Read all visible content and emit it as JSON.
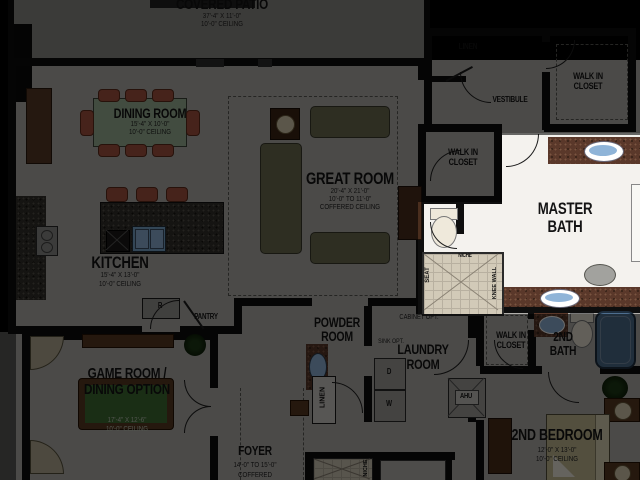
{
  "plan": {
    "covered_patio": {
      "name": "COVERED PATIO",
      "dims": "37'-4\" X 11'-0\"",
      "ceiling": "10'-0\" CEILING"
    },
    "dining_room": {
      "name": "DINING ROOM",
      "dims": "15'-4\" X 10'-0\"",
      "ceiling": "10'-0\" CEILING"
    },
    "great_room": {
      "name": "GREAT ROOM",
      "dims": "20'-4\" X 21'-0\"",
      "ceiling_range": "10'-0\" TO 11'-0\"",
      "ceiling_type": "COFFERED CEILING"
    },
    "kitchen": {
      "name": "KITCHEN",
      "dims": "15'-4\" X 13'-0\"",
      "ceiling": "10'-0\" CEILING"
    },
    "pantry": {
      "name": "PANTRY"
    },
    "refrigerator": {
      "abbr": "R"
    },
    "linen_upper": {
      "name": "LINEN"
    },
    "vestibule": {
      "name": "VESTIBULE"
    },
    "walk_in_closet_top": {
      "name": "WALK IN CLOSET"
    },
    "walk_in_closet_mid": {
      "name": "WALK IN CLOSET"
    },
    "walk_in_closet_bottom": {
      "name": "WALK IN CLOSET"
    },
    "master_bath": {
      "name": "MASTER BATH",
      "niche": "NICHE",
      "seat": "SEAT",
      "knee_wall": "KNEE WALL"
    },
    "powder_room": {
      "name": "POWDER ROOM"
    },
    "laundry_room": {
      "name": "LAUNDRY ROOM",
      "cabinet_opt": "CABINET OPT.",
      "sink_opt": "SINK OPT.",
      "dryer": "D",
      "washer": "W"
    },
    "linen_hall": {
      "name": "LINEN"
    },
    "ahu": {
      "name": "AHU"
    },
    "second_bath": {
      "name": "2ND BATH"
    },
    "second_bedroom": {
      "name": "2ND BEDROOM",
      "dims": "12'-0\" X 13'-0\"",
      "ceiling": "10'-0\" CEILING"
    },
    "game_room": {
      "name": "GAME ROOM / DINING OPTION",
      "dims": "17'-4\" X 12'-6\"",
      "ceiling": "10'-0\" CEILING"
    },
    "foyer": {
      "name": "FOYER",
      "dims": "14'-0\" TO 15'-0\"",
      "ceiling_type": "COFFERED"
    },
    "niche_lower": {
      "name": "NICHE"
    }
  },
  "colors": {
    "wall": "#0e0e0e",
    "floor": "#b2b0ac",
    "patio_floor": "#8e8c88",
    "master_floor": "#f4f2ee",
    "counter_granite": "#5a382a",
    "sink_blue": "#8fb4d8",
    "dining_table_green": "#9db698",
    "chair_red": "#a85440",
    "sofa_olive": "#6e6e52",
    "pool_felt_green": "#3e6e34",
    "tub_blue": "#4e6e8e",
    "shower_tile": "#d2cab8",
    "highlight_overlay": "rgba(0,0,0,0.58)"
  }
}
